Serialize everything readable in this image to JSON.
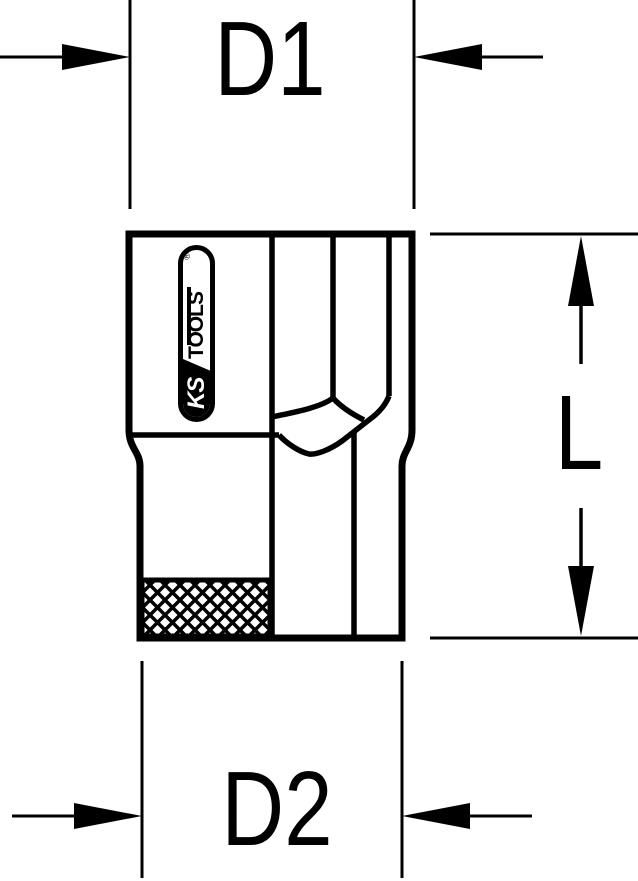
{
  "drawing": {
    "dimensions": {
      "d1": "D1",
      "d2": "D2",
      "length": "L"
    },
    "logo": {
      "ks": "KS",
      "tools": "TOOLS",
      "registered": "®"
    },
    "colors": {
      "line": "#000000",
      "background": "#ffffff"
    }
  }
}
